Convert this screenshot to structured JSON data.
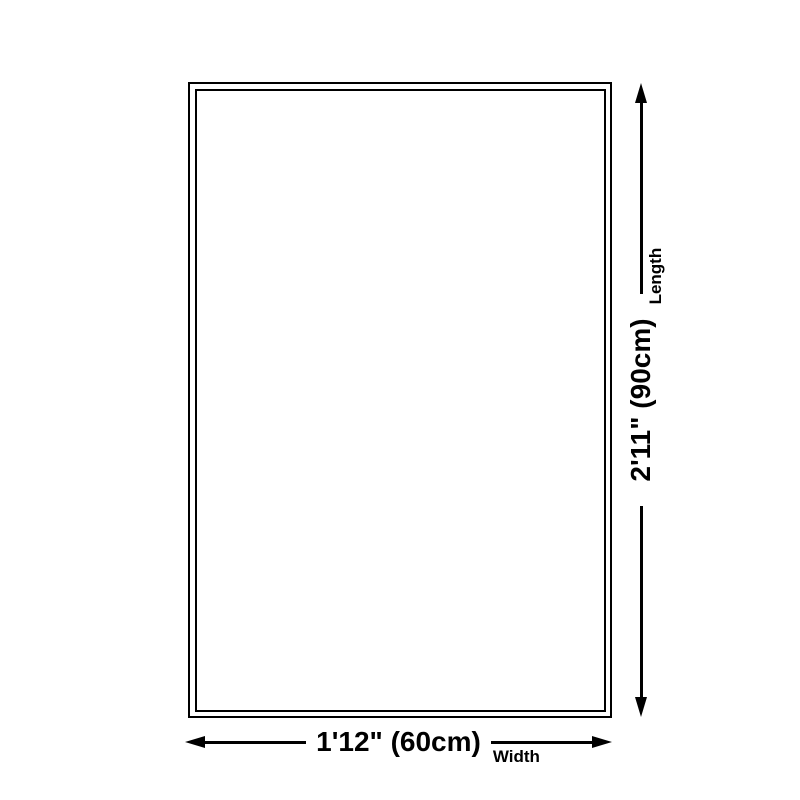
{
  "colors": {
    "background": "#ffffff",
    "line": "#000000"
  },
  "rug": {
    "shape": "rectangle-double-border"
  },
  "dimensions": {
    "length": {
      "value": "2'11\" (90cm)",
      "label": "Length",
      "orientation": "vertical",
      "start_icon": "arrow-down-icon",
      "end_icon": "arrow-up-icon"
    },
    "width": {
      "value": "1'12\" (60cm)",
      "label": "Width",
      "orientation": "horizontal",
      "start_icon": "arrow-left-icon",
      "end_icon": "arrow-right-icon"
    }
  }
}
